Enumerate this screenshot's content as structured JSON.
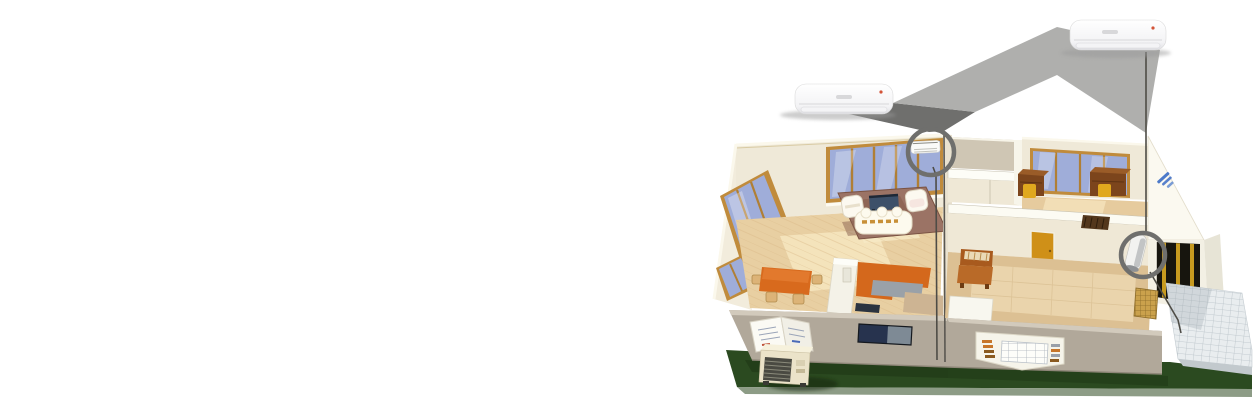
{
  "scene": {
    "title": "Cutaway house illustration showing multi-split air conditioner installation",
    "background_color": "#ffffff",
    "rooms": [
      "living-dining-kitchen",
      "hallway-closet",
      "study",
      "tatami-room",
      "entrance-porch"
    ],
    "palette": {
      "lawn": "#2b4a20",
      "lawn_bevel": "#8d9c86",
      "interior_wall": "#efe9d8",
      "closet_wall": "#cfc6b4",
      "exterior_wall": "#b1a89a",
      "exterior_wall_top": "#d2cabc",
      "window_glass": "#9fadd9",
      "window_frame": "#c08b3c",
      "floor_wood": "#e8cfa2",
      "tatami_floor": "#dcc093",
      "rug": "#9b7365",
      "sofa": "#fdfaee",
      "kitchen_orange": "#d4681c",
      "door_orange": "#cf9018",
      "desk_brown": "#7c451c",
      "chair_yellow": "#e0a81e",
      "terrace_tile": "#e9edef",
      "beam_gray": "#a6a6a4",
      "beam_dark": "#6f6f6d",
      "connector_line": "#4e4c46",
      "callout_ring": "#6f6f6d",
      "ac_body": "#f7f7f7",
      "ac_indicator": "#d35438",
      "gable_logo_blue": "#3a6bc4",
      "outdoor_unit_body": "#ebe3c9"
    },
    "products": [
      {
        "id": "indoor-unit-product-left",
        "label": "wall-mounted indoor unit (living room)"
      },
      {
        "id": "indoor-unit-product-right",
        "label": "wall-mounted indoor unit (entrance)"
      }
    ],
    "callouts": [
      {
        "id": "living-room-callout",
        "label": "installed indoor unit – living room wall",
        "cx": 931,
        "cy": 152,
        "r": 23
      },
      {
        "id": "entrance-callout",
        "label": "installed indoor unit – entrance wall",
        "cx": 1143,
        "cy": 255,
        "r": 22
      }
    ],
    "outdoor_unit": {
      "id": "outdoor-condenser-unit",
      "label": "outdoor condenser unit on lawn"
    }
  }
}
